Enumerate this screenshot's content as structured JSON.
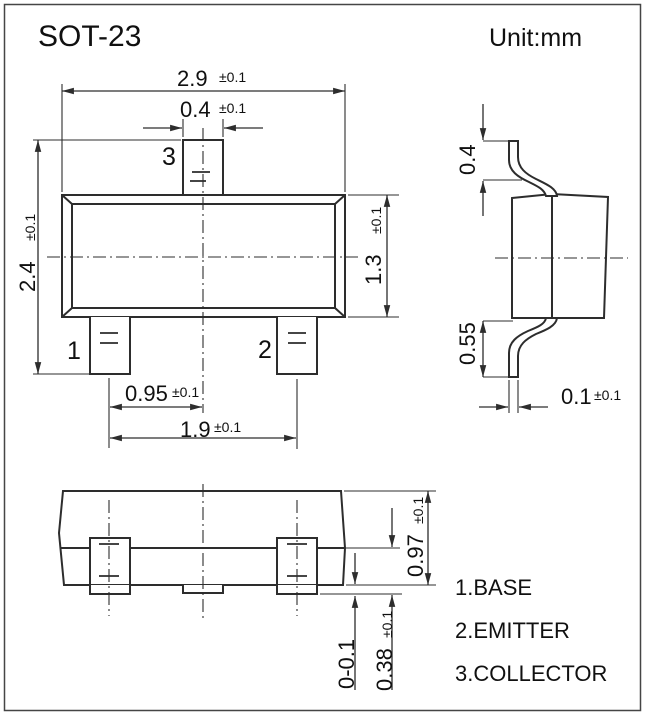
{
  "title": "SOT-23",
  "unit_label": "Unit:mm",
  "colors": {
    "line": "#2d2d2d",
    "text": "#101010",
    "background": "#ffffff",
    "border": "#454545"
  },
  "front_view": {
    "pin_labels": {
      "pin1": "1",
      "pin2": "2",
      "pin3": "3"
    },
    "dims": {
      "body_width": {
        "value": "2.9",
        "tol": "±0.1"
      },
      "pin3_width": {
        "value": "0.4",
        "tol": "±0.1"
      },
      "overall_height": {
        "value": "2.4",
        "tol": "±0.1"
      },
      "body_height": {
        "value": "1.3",
        "tol": "±0.1"
      },
      "pin_pitch": {
        "value": "0.95",
        "tol": "±0.1"
      },
      "pin_span": {
        "value": "1.9",
        "tol": "±0.1"
      }
    }
  },
  "side_view": {
    "dims": {
      "lead_top_length": {
        "value": "0.4"
      },
      "lead_bottom_length": {
        "value": "0.55"
      },
      "lead_thickness": {
        "value": "0.1",
        "tol": "±0.1"
      }
    }
  },
  "bottom_view": {
    "dims": {
      "body_side_height": {
        "value": "0.97",
        "tol": "±0.1"
      },
      "standoff": {
        "value": "0-0.1"
      },
      "foot_height": {
        "value": "0.38",
        "tol": "±0.1"
      }
    }
  },
  "legend": {
    "items": [
      "1.BASE",
      "2.EMITTER",
      "3.COLLECTOR"
    ]
  }
}
